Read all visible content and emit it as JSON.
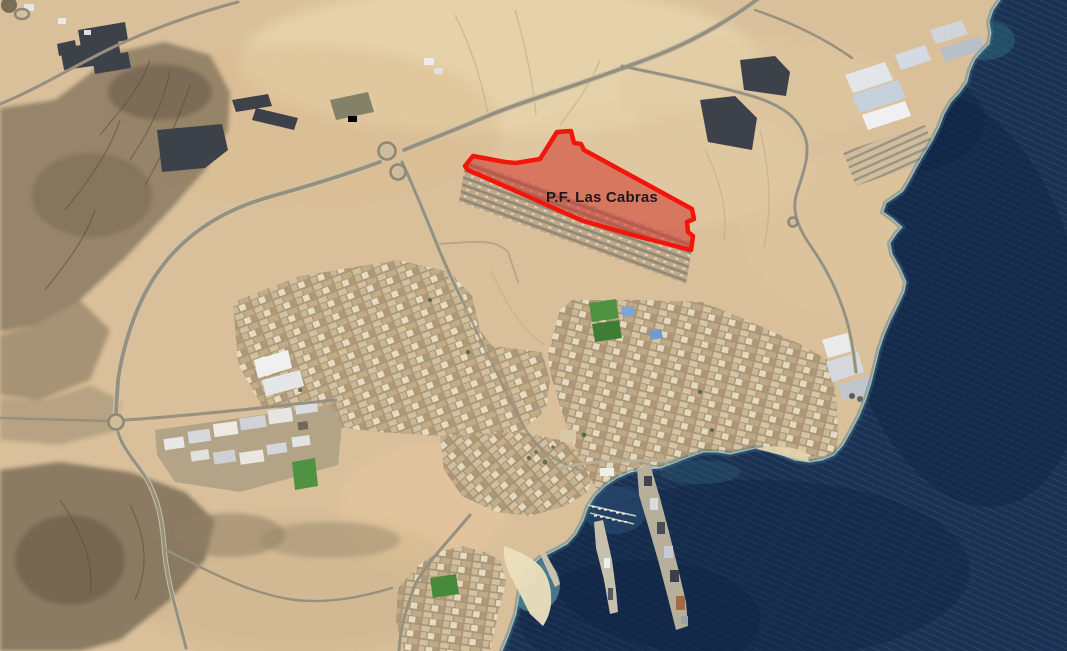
{
  "annotation": {
    "label": "P.F. Las Cabras",
    "label_color": "#1b1b1b",
    "zone_fill": "#d0342c",
    "zone_fill_opacity": "0.55",
    "zone_stroke": "#f2150a",
    "zone_stroke_width": "4.5"
  },
  "palette": {
    "sand": "#d9c09b",
    "sand_light": "#ead8b0",
    "rock": "#8a7a62",
    "rock_dark": "#6e604b",
    "ocean": "#1b3252",
    "ocean_deep": "#0e2342",
    "nearshore": "#3a7487",
    "foam": "#dcebe4",
    "beach_water": "#6fb3ba",
    "road": "#97907e",
    "road_light": "#cfc4a9",
    "urban_street": "#a89879",
    "warehouse_roof": "#e3e6ea",
    "solar_panel": "#3d424a",
    "sports_field_green": "#4e9242",
    "pier_concrete": "#b6af9c"
  }
}
